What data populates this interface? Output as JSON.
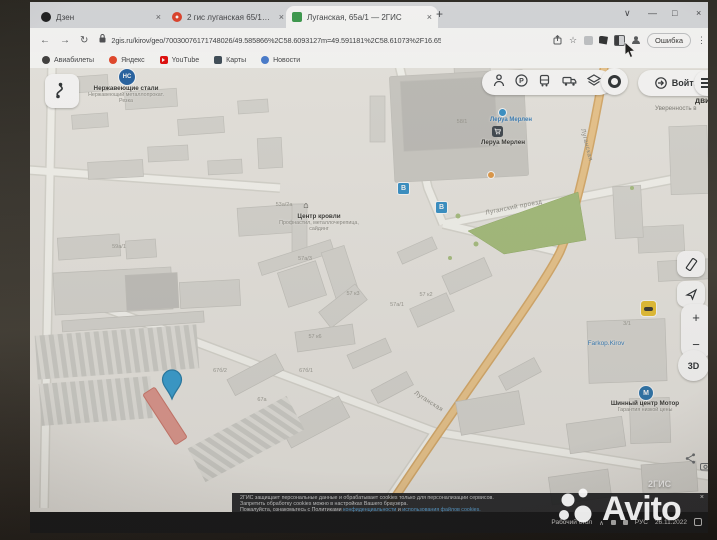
{
  "window": {
    "tabs": [
      {
        "title": "Дзен"
      },
      {
        "title": "2 гис луганская 65/1 киров — Я"
      },
      {
        "title": "Луганская, 65а/1 — 2ГИС"
      }
    ],
    "new_tab": "+",
    "tab_close": "×",
    "controls": {
      "tab_search": "∨",
      "minimize": "—",
      "maximize": "□",
      "close": "×"
    },
    "nav": {
      "back": "←",
      "forward": "→",
      "reload": "↻"
    },
    "address": {
      "url": "2gis.ru/kirov/geo/70030076171748026/49.585866%2C58.6093127m=49.591181%2C58.61073%2F16.65"
    },
    "star": "☆",
    "error_button": "Ошибка",
    "menu_dots": "⋮",
    "bookmarks": [
      {
        "label": "Авиабилеты"
      },
      {
        "label": "Яндекс"
      },
      {
        "label": "YouTube"
      },
      {
        "label": "Карты"
      },
      {
        "label": "Новости"
      }
    ]
  },
  "map": {
    "login_button": "Войти",
    "controls": {
      "zoom_in": "+",
      "zoom_out": "−",
      "view_3d": "3D"
    },
    "ad_teaser": {
      "line1": "дви",
      "line2": "Уверенность в"
    },
    "pois": {
      "steel": {
        "badge": "НС",
        "title": "Нержавеющие стали",
        "subtitle1": "Нержавеющий металлопрокат.",
        "subtitle2": "Резка"
      },
      "leroy_stop": "Леруа Мерлен",
      "leroy_store": "Леруа Мерлен",
      "roof": {
        "icon": "⌂",
        "title": "Центр кровли",
        "subtitle1": "Профнастил, металлочерепица,",
        "subtitle2": "сайдинг"
      },
      "farkop": "Farkop.Kirov",
      "tyre": {
        "badge": "М",
        "title": "Шинный центр Мотор",
        "subtitle": "Гарантия низкой цены"
      },
      "bus_badge": "В"
    },
    "streets": {
      "lugansky_proezd": "Луганский проезд",
      "luganskaya_top": "Луганская",
      "luganskaya_bottom": "Луганская"
    },
    "building_labels": [
      {
        "text": "58/1"
      },
      {
        "text": "53а/2а"
      },
      {
        "text": "57а/3"
      },
      {
        "text": "57 к3"
      },
      {
        "text": "57 к2"
      },
      {
        "text": "57а/1"
      },
      {
        "text": "57 к6"
      },
      {
        "text": "67б/2"
      },
      {
        "text": "67б/1"
      },
      {
        "text": "67а"
      },
      {
        "text": "59а/1"
      },
      {
        "text": "3/1"
      }
    ],
    "logo": "2ГИС"
  },
  "cookie_banner": {
    "line1": "2ГИС защищает персональные данные и обрабатывает cookies только для персонализации сервисов.",
    "line2": "Запретить обработку cookies можно в настройках Вашего браузера.",
    "line3_prefix": "Пожалуйста, ознакомьтесь с Политиками ",
    "link1": "конфиденциальности",
    "line3_mid": " и ",
    "link2": "использования файлов cookies.",
    "close": "×"
  },
  "taskbar": {
    "desktop_label": "Рабочий стол",
    "chevron": "∧",
    "lang": "РУС",
    "date": "26.11.2022"
  },
  "watermark": "Avito",
  "colors": {
    "accent_blue": "#2b95d6",
    "road_orange": "#f4c987",
    "park_green": "#a6c377",
    "selected_red": "#e9968c"
  }
}
